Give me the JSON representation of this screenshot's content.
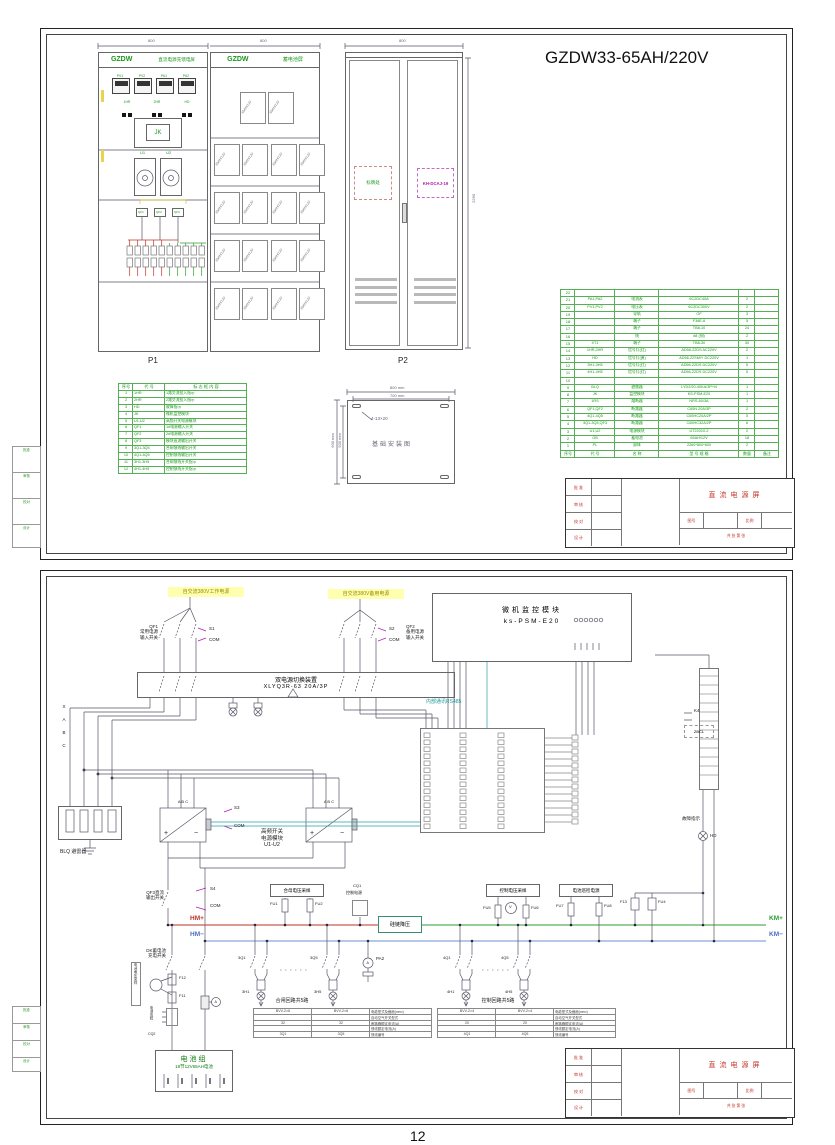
{
  "page": {
    "footer_page_number": "12"
  },
  "s1": {
    "drawing_title": "GZDW33-65AH/220V",
    "dims": {
      "p1_width": "800",
      "bat_width": "800",
      "p2_width": "800",
      "height": "2260"
    },
    "p1": {
      "brand": "GZDW",
      "panel_name": "直流电源充馈电屏",
      "label": "P1",
      "meters": [
        "PV1",
        "PV2",
        "PA1",
        "PA2"
      ],
      "lamps": [
        "1HR",
        "2HR",
        "HD"
      ],
      "jk_label": "JK",
      "module_labels": [
        "U1",
        "U2"
      ],
      "breakers": [
        "QF1",
        "QF2",
        "QF3"
      ]
    },
    "bat": {
      "brand": "GZDW",
      "panel_name": "蓄电池屏"
    },
    "bat_rows": [
      [
        "65AH/12V",
        "65AH/12V"
      ],
      [
        "65AH/12V",
        "65AH/12V",
        "65AH/12V",
        "65AH/12V"
      ],
      [
        "65AH/12V",
        "65AH/12V",
        "65AH/12V",
        "65AH/12V"
      ],
      [
        "65AH/12V",
        "65AH/12V",
        "65AH/12V",
        "65AH/12V"
      ],
      [
        "65AH/12V",
        "65AH/12V",
        "65AH/12V",
        "65AH/12V"
      ]
    ],
    "p2": {
      "label": "P2",
      "nameplate": "标牌处",
      "module": "KH-DCAJ-19"
    },
    "legend": {
      "headers": [
        "序号",
        "代  号",
        "标 志 框 内 容"
      ],
      "rows": [
        [
          "1",
          "1HR",
          "1路交流投入指示"
        ],
        [
          "2",
          "2HR",
          "2路交流投入指示"
        ],
        [
          "3",
          "HD",
          "故障指示"
        ],
        [
          "4",
          "JK",
          "微机监控模块"
        ],
        [
          "5",
          "U1,U2",
          "高频开关电源模块"
        ],
        [
          "6",
          "QF1",
          "1#电源输入开关"
        ],
        [
          "7",
          "QF2",
          "2#电源输入开关"
        ],
        [
          "8",
          "QF3",
          "模块直流输出开关"
        ],
        [
          "9",
          "3Q1-3Q5",
          "合闸馈线输出开关"
        ],
        [
          "10",
          "4Q1-4Q5",
          "控制馈线输出开关"
        ],
        [
          "11",
          "3H1-3H5",
          "合闸馈线开关指示"
        ],
        [
          "12",
          "4H1-4H5",
          "控制馈线开关指示"
        ]
      ]
    },
    "foundation": {
      "title": "基础安装图",
      "holes": "4-13×20",
      "dim_top1": "800 mm",
      "dim_top2": "700 mm",
      "dim_left1": "600 mm",
      "dim_left2": "500 mm"
    },
    "bom": {
      "rows": [
        [
          "22",
          "",
          "",
          "",
          "",
          ""
        ],
        [
          "21",
          "PA1,PA2",
          "电流表",
          "6C2DC40A",
          "2",
          ""
        ],
        [
          "20",
          "PV1,PV2",
          "电压表",
          "6C2DC300V",
          "2",
          ""
        ],
        [
          "19",
          "",
          "导轨",
          "OF",
          "3",
          ""
        ],
        [
          "18",
          "",
          "端子",
          "F36E-6",
          "5",
          ""
        ],
        [
          "17",
          "",
          "端子",
          "TB8-10",
          "24",
          ""
        ],
        [
          "16",
          "",
          "线",
          "#8 (铜)",
          "2",
          ""
        ],
        [
          "15",
          "XT1",
          "端子",
          "TB8-30",
          "30",
          ""
        ],
        [
          "14",
          "1HR,2HR",
          "信号灯(红)",
          "AD56-22DS AC220V",
          "2",
          ""
        ],
        [
          "13",
          "HD",
          "信号灯(黄)",
          "AD56-22SM/Y DC220V",
          "1",
          ""
        ],
        [
          "12",
          "3H1-3H5",
          "信号灯(红)",
          "AD56-22DS DC220V",
          "5",
          ""
        ],
        [
          "11",
          "4H1-4H5",
          "信号灯(红)",
          "AD56-22DS DC220V",
          "5",
          ""
        ],
        [
          "10",
          "",
          "",
          "",
          "",
          ""
        ],
        [
          "9",
          "BLQ",
          "避雷器",
          "LYD2/20-40KA/3P+N",
          "1",
          ""
        ],
        [
          "8",
          "JK",
          "监控模块",
          "KS-PSM-E20",
          "1",
          ""
        ],
        [
          "7",
          "1RS",
          "熔断器",
          "NRS-60/3A",
          "1",
          ""
        ],
        [
          "6",
          "QF1,QF2",
          "断路器",
          "C65N 20A/3P",
          "2",
          ""
        ],
        [
          "5",
          "4Q1-4Q5",
          "断路器",
          "C65HC20A/2P",
          "5",
          ""
        ],
        [
          "4",
          "3Q1-3Q5,QF3",
          "断路器",
          "C65HC32A/2P",
          "6",
          ""
        ],
        [
          "3",
          "U1,U2",
          "电源模块",
          "UT22010-2",
          "2",
          ""
        ],
        [
          "2",
          "GB",
          "蓄电池",
          "65AH/12V",
          "18",
          ""
        ],
        [
          "1",
          "PL",
          "屏体",
          "2260*800*600",
          "2",
          ""
        ]
      ],
      "footer": [
        "序号",
        "代  号",
        "名  称",
        "型 号 规 格",
        "数量",
        "备注"
      ]
    },
    "tb": {
      "title": "直流电源屏",
      "fields": [
        "批 准",
        "审 核",
        "校 对",
        "设 计"
      ],
      "sub1": "图号",
      "sub2": "比例",
      "pages": "共  张  第  张"
    },
    "margin": [
      "批准",
      "审核",
      "校对",
      "设计"
    ]
  },
  "s2": {
    "src_left": "自交流380V工作电源",
    "src_right": "自交流380V备用电源",
    "qf1": [
      "QF1",
      "常用电源",
      "输入开关"
    ],
    "s1c": [
      "S1",
      "COM"
    ],
    "qf2": [
      "QF2",
      "备用电源",
      "输入开关"
    ],
    "s2c": [
      "S2",
      "COM"
    ],
    "ats": [
      "双电源切换装置",
      "XLYQ3R-63 20A/3P"
    ],
    "phases": [
      "X",
      "A",
      "B",
      "C"
    ],
    "monitor": [
      "微机监控模块",
      "ks-PSM-E20"
    ],
    "rs485": "内部通讯RS485",
    "blq": "BLQ 避雷器",
    "s3c": [
      "S3",
      "COM"
    ],
    "rect_pins": "A  B  C",
    "rect_plus": "+",
    "rect_minus": "−",
    "rect_label": [
      "高频开关",
      "电源模块",
      "U1-U2"
    ],
    "qf3": [
      "QF3直流",
      "输出开关"
    ],
    "s4c": [
      "S4",
      "COM"
    ],
    "bus": {
      "hm_plus": "HM+",
      "hm_minus": "HM−",
      "km_plus": "KM+",
      "km_minus": "KM−"
    },
    "stepdown": "硅链降压",
    "sample1": "合母电压采样",
    "fu1": "FU1",
    "fu2": "FU2",
    "cq1": [
      "CQ1",
      "控制电源"
    ],
    "sample2": "控制电压采样",
    "fu5": "FU5",
    "fu6": "FU6",
    "vmeter": "V",
    "patrol": "电池巡检电源",
    "fu7": "FU7",
    "fu8": "FU8",
    "fu3": "F13",
    "fu4": "FU4",
    "k4": "K4",
    "zbcl": "ZBCL",
    "fault": [
      "故障指示",
      "HD"
    ],
    "charge_switch": [
      "DK蓄电池",
      "充电开关"
    ],
    "bat_sample": "电池电压采样",
    "f12": "F12",
    "f11": "F11",
    "cq2": [
      "电池巡检",
      "CQ2"
    ],
    "pa2": "PA2",
    "ameter": "A",
    "battery": [
      "电池组",
      "18节12V65AH电池"
    ],
    "feeders": {
      "left_title": "合闸回路共5路",
      "right_title": "控制回路共5路",
      "dots": "······",
      "lq1": "3Q1",
      "lh1": "3H1",
      "lq5": "3Q5",
      "lh5": "3H5",
      "rq1": "4Q1",
      "rh1": "4H1",
      "rq5": "4Q5",
      "rh5": "4H5",
      "lt_rows": [
        [
          "BVV-2×6",
          "BVV-2×6",
          "电缆型式及截面(mm²)"
        ],
        [
          "",
          "",
          "自动空气开关型式"
        ],
        [
          "32",
          "32",
          "断路器额定电流(A)"
        ],
        [
          "",
          "",
          "馈线额定电流(A)"
        ],
        [
          "3Q1",
          "3Q5",
          "馈线编号"
        ]
      ],
      "rt_rows": [
        [
          "BVV-2×4",
          "BVV-2×4",
          "电缆型式及截面(mm²)"
        ],
        [
          "",
          "",
          "自动空气开关型式"
        ],
        [
          "20",
          "20",
          "断路器额定电流(A)"
        ],
        [
          "",
          "",
          "馈线额定电流(A)"
        ],
        [
          "4Q1",
          "4Q5",
          "馈线编号"
        ]
      ]
    },
    "tb": {
      "title": "直流电源屏",
      "fields": [
        "批 准",
        "审 核",
        "校 对",
        "设 计"
      ],
      "sub1": "图号",
      "sub2": "比例",
      "pages": "共  张  第  张"
    },
    "margin": [
      "批准",
      "审核",
      "校对",
      "设计"
    ]
  }
}
